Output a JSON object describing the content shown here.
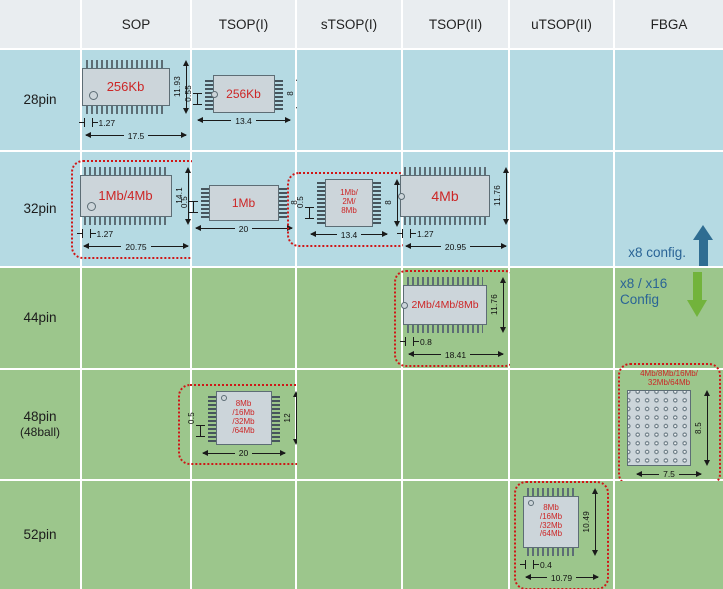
{
  "columns": [
    "SOP",
    "TSOP(I)",
    "sTSOP(I)",
    "TSOP(II)",
    "uTSOP(II)",
    "FBGA"
  ],
  "rows": [
    {
      "label": "28pin"
    },
    {
      "label": "32pin"
    },
    {
      "label": "44pin"
    },
    {
      "label": "48pin",
      "sublabel": "(48ball)"
    },
    {
      "label": "52pin"
    }
  ],
  "legend": {
    "x8_label": "x8 config.",
    "x16_line1": "x8 / x16",
    "x16_line2": "Config"
  },
  "colors": {
    "header_bg": "#e9edf0",
    "blue_row_bg": "#b5dae3",
    "green_row_bg": "#9cc68c",
    "chip_body": "#ccd5da",
    "capacity_text": "#cc2626",
    "highlight_dotted": "#cf1717",
    "arrow_up_blue": "#2f6d92",
    "arrow_down_green": "#72b33c",
    "legend_text": "#2a6496"
  },
  "chips": {
    "sop_28": {
      "capacity": "256Kb",
      "height": "11.93",
      "pitch": "1.27",
      "width": "17.5"
    },
    "tsop1_28": {
      "capacity": "256Kb",
      "pitch": "0.55",
      "height": "8",
      "width": "13.4"
    },
    "sop_32": {
      "capacity": "1Mb/4Mb",
      "height": "14.1",
      "pitch": "1.27",
      "width": "20.75"
    },
    "tsop1_32": {
      "capacity": "1Mb",
      "pitch": "0.5",
      "height": "8",
      "width": "20"
    },
    "stsop1_32": {
      "capacity_lines": [
        "1Mb/",
        "2M/",
        "8Mb"
      ],
      "pitch": "0.5",
      "height": "8",
      "width": "13.4"
    },
    "tsop2_32": {
      "capacity": "4Mb",
      "height": "11.76",
      "pitch": "1.27",
      "width": "20.95"
    },
    "tsop2_44": {
      "capacity": "2Mb/4Mb/8Mb",
      "height": "11.76",
      "pitch": "0.8",
      "width": "18.41"
    },
    "tsop1_48": {
      "capacity_lines": [
        "8Mb",
        "/16Mb",
        "/32Mb",
        "/64Mb"
      ],
      "pitch": "0.5",
      "height": "12",
      "width": "20"
    },
    "fbga_48": {
      "capacity_lines": [
        "4Mb/8Mb/16Mb/",
        "32Mb/64Mb"
      ],
      "height": "8.5",
      "width": "7.5"
    },
    "utsop2_52": {
      "capacity_lines": [
        "8Mb",
        "/16Mb",
        "/32Mb",
        "/64Mb"
      ],
      "height": "10.49",
      "pitch": "0.4",
      "width": "10.79"
    }
  }
}
